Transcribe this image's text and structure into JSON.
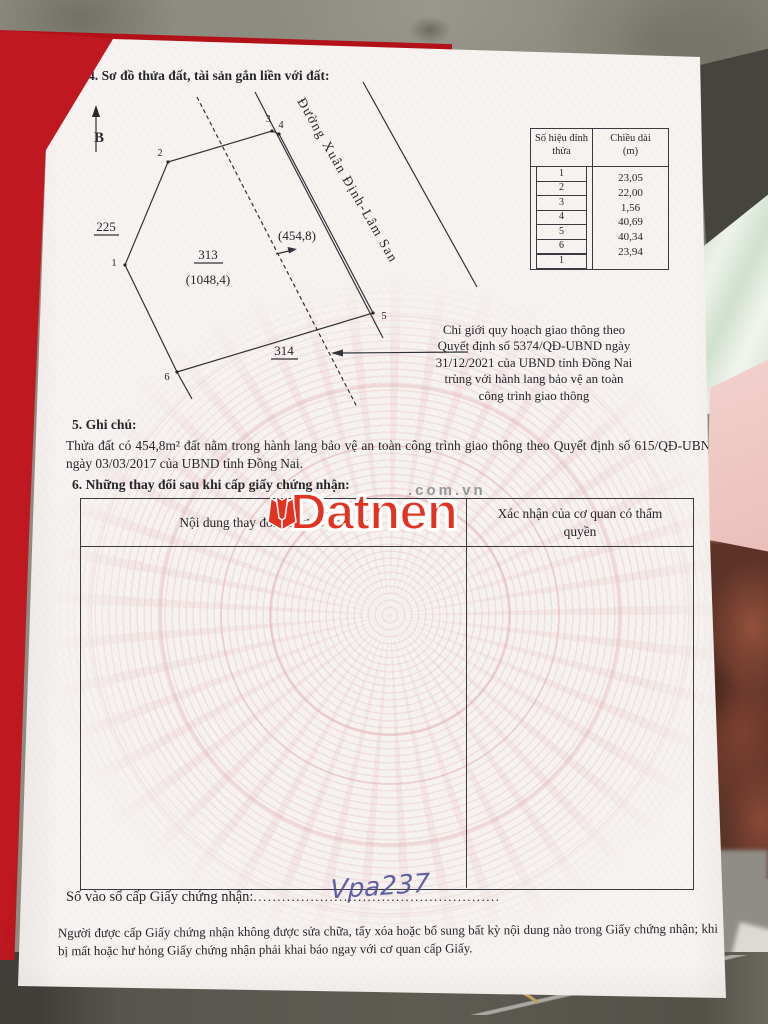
{
  "document": {
    "section4_title": "4. Sơ đồ thửa đất, tài sản gắn liền với đất:",
    "diagram": {
      "north_label": "B",
      "road_name": "Đường Xuân Định-Lâm San",
      "parcel_number": "313",
      "parcel_area_label": "(1048,4)",
      "corridor_area_label": "(454,8)",
      "adjacent_parcel_left": "225",
      "adjacent_parcel_bottom": "314",
      "vertex_labels": [
        "1",
        "2",
        "3",
        "4",
        "5",
        "6"
      ],
      "planning_note_lines": [
        "Chỉ giới quy hoạch giao thông theo",
        "Quyết định số 5374/QĐ-UBND ngày",
        "31/12/2021 của UBND tỉnh Đồng Nai",
        "trùng với hành lang bảo vệ an toàn",
        "công trình giao thông"
      ]
    },
    "length_table": {
      "header_col1": "Số hiệu đỉnh thửa",
      "header_col2_line1": "Chiều dài",
      "header_col2_line2": "(m)",
      "vertex_ids": [
        "1",
        "2",
        "3",
        "4",
        "5",
        "6",
        "1"
      ],
      "lengths_m": [
        "23,05",
        "22,00",
        "1,56",
        "40,69",
        "40,34",
        "23,94"
      ]
    },
    "section5_title": "5. Ghi chú:",
    "section5_text": "Thửa đất có 454,8m² đất nằm trong hành lang bảo vệ an toàn công trình giao thông theo Quyết định số 615/QĐ-UBND ngày 03/03/2017 của UBND tỉnh Đồng Nai.",
    "section6_title": "6. Những thay đổi sau khi cấp giấy chứng nhận:",
    "changes_table": {
      "header_col1": "Nội dung thay đổi và cơ sở pháp lý",
      "header_col2": "Xác nhận của cơ quan có thẩm quyền"
    },
    "footer": {
      "register_label": "Số vào sổ cấp Giấy chứng nhận:",
      "register_dots": "....................................................",
      "register_value_handwritten": "Vpa237",
      "notice": "Người được cấp Giấy chứng nhận không được sửa chữa, tẩy xóa hoặc bổ sung bất kỳ nội dung nào trong Giấy chứng nhận; khi bị mất hoặc hư hỏng Giấy chứng nhận phải khai báo ngay với cơ quan cấp Giấy."
    },
    "watermark": {
      "brand": "Datnen",
      "suffix": ".com.vn",
      "brand_color": "#e23222"
    }
  }
}
